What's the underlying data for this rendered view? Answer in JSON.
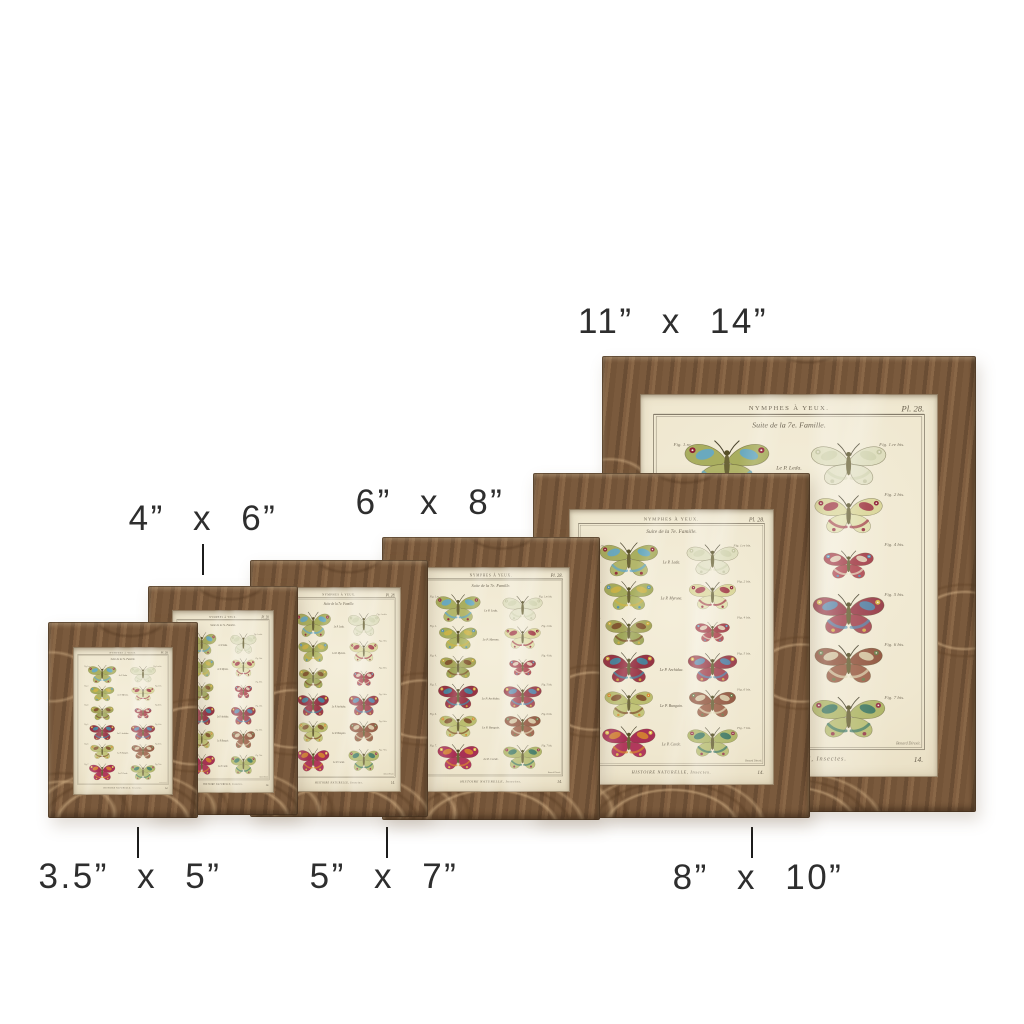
{
  "page": {
    "background_color": "#ffffff"
  },
  "product": {
    "description": "Six rustic wood picture frames with vintage butterfly plate prints, shown in graduated sizes",
    "sizes": [
      "3.5\" x 5\"",
      "4\" x 6\"",
      "5\" x 7\"",
      "6\" x 8\"",
      "8\" x 10\"",
      "11\" x 14\""
    ]
  },
  "labels": {
    "size_3_5x5": "3.5” x 5”",
    "size_4x6": "4” x 6”",
    "size_5x7": "5” x 7”",
    "size_6x8": "6” x 8”",
    "size_8x10": "8” x 10”",
    "size_11x14": "11” x 14”"
  },
  "label_style": {
    "text_color": "#2e2e2e",
    "tick_color": "#1c1c1c"
  },
  "wood": {
    "base": "#7a5a3d",
    "dark": "#5f452c",
    "light": "#c4a37b",
    "highlight": "#d9bd97"
  },
  "plate": {
    "header": "NYMPHES À YEUX.",
    "plate_no": "Pl. 28.",
    "subtitle": "Suite de la 7e. Famille.",
    "footer": "HISTOIRE NATURELLE, Insectes.",
    "page_no": "14.",
    "credit": "Benard Direxit.",
    "paper_color": "#f1ead4",
    "ink_color": "#6a6150",
    "rows": [
      {
        "caption": "Le P. Leda.",
        "fig_left": "Fig. 1.re",
        "fig_right": "Fig. 1.re bis.",
        "left": {
          "fw": "#a3a855",
          "hw": "#aeb162",
          "ac": "#5fa8cf",
          "sp": "#8e2136"
        },
        "right": {
          "fw": "#cbd1a8",
          "hw": "#d4d8b6",
          "ac": "#b9c194",
          "sp": "#9aa176",
          "pale": true
        }
      },
      {
        "caption": "Le P. Myrone.",
        "fig_left": "Fig. 2.",
        "fig_right": "Fig. 2 bis.",
        "left": {
          "fw": "#9ea652",
          "hw": "#a9b05c",
          "ac": "#d0b445",
          "sp": "#4f8fb5"
        },
        "right": {
          "fw": "#d8d494",
          "hw": "#e0dda8",
          "ac": "#99273c",
          "sp": "#8e2136"
        }
      },
      {
        "caption": "",
        "fig_left": "Fig. 4.",
        "fig_right": "Fig. 4 bis.",
        "left": {
          "fw": "#a0a050",
          "hw": "#98a04e",
          "ac": "#7c4a2b",
          "sp": "#d4b23e"
        },
        "right": {
          "fw": "#9c2f3c",
          "hw": "#a83a44",
          "ac": "#e6ddbe",
          "sp": "#4f8fb5"
        }
      },
      {
        "caption": "Le P. Archiduc.",
        "fig_left": "Fig. 5.",
        "fig_right": "Fig. 5 bis.",
        "left": {
          "fw": "#8e2438",
          "hw": "#962a3e",
          "ac": "#3f8fa8",
          "sp": "#d4b23e"
        },
        "right": {
          "fw": "#93303f",
          "hw": "#9d3a47",
          "ac": "#4f8fb5",
          "sp": "#d8b84a"
        }
      },
      {
        "caption": "Le P. Bungain.",
        "fig_left": "Fig. 6.",
        "fig_right": "Fig. 6 bis.",
        "left": {
          "fw": "#b5b867",
          "hw": "#bfc173",
          "ac": "#7c4a2b",
          "sp": "#d78a2e"
        },
        "right": {
          "fw": "#8a4a33",
          "hw": "#95553c",
          "ac": "#ded5b0",
          "sp": "#6b7c4a"
        }
      },
      {
        "caption": "Le P. Carde.",
        "fig_left": "Fig. 7.",
        "fig_right": "Fig. 7 bis.",
        "left": {
          "fw": "#a21f4a",
          "hw": "#ab2a52",
          "ac": "#d78a2e",
          "sp": "#e3c84f"
        },
        "right": {
          "fw": "#a9b15d",
          "hw": "#b2b869",
          "ac": "#2f6f62",
          "sp": "#943048"
        }
      }
    ]
  }
}
